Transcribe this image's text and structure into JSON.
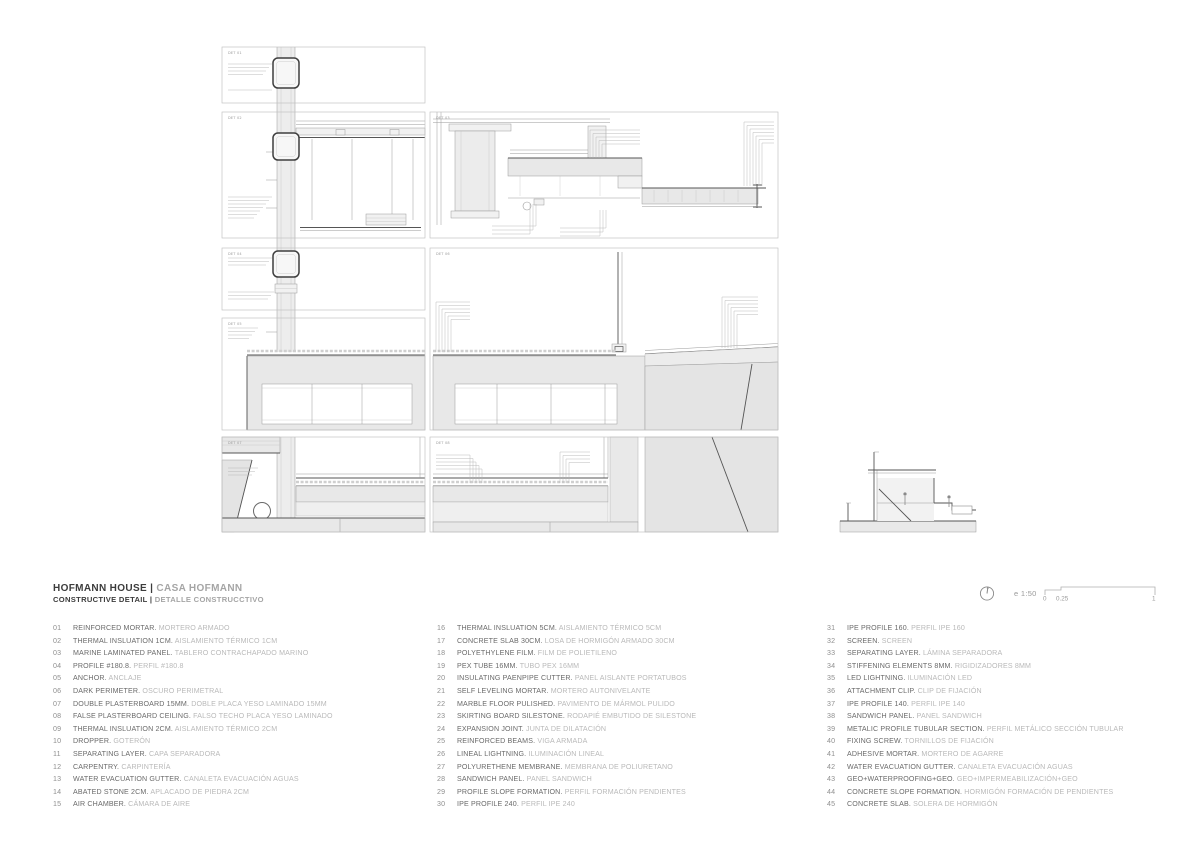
{
  "sheet": {
    "title_left": "HOFMANN HOUSE |",
    "title_right": "CASA HOFMANN",
    "subtitle_left": "CONSTRUCTIVE DETAIL |",
    "subtitle_right": "DETALLE CONSTRUCCTIVO"
  },
  "scale": {
    "label": "e 1:50",
    "tick0": "0",
    "tick025": "0.25",
    "tick1": "1"
  },
  "panels": [
    {
      "label": "DET 01"
    },
    {
      "label": "DET 02"
    },
    {
      "label": "DET 03"
    },
    {
      "label": "DET 04"
    },
    {
      "label": "DET 05"
    },
    {
      "label": "DET 06"
    },
    {
      "label": "DET 07"
    },
    {
      "label": "DET 08"
    }
  ],
  "colors": {
    "line_dark": "#555555",
    "line_light": "#9a9a9a",
    "fill_light": "#e8e8e8",
    "text_dark": "#3c3c3c",
    "text_mid": "#6a6a6a",
    "text_light": "#b9b9b9"
  },
  "legend": {
    "columns": [
      [
        {
          "num": "01",
          "en": "REINFORCED MORTAR.",
          "es": "MORTERO ARMADO"
        },
        {
          "num": "02",
          "en": "THERMAL INSLUATION 1CM.",
          "es": "AISLAMIENTO TÉRMICO 1CM"
        },
        {
          "num": "03",
          "en": "MARINE LAMINATED PANEL.",
          "es": "TABLERO CONTRACHAPADO MARINO"
        },
        {
          "num": "04",
          "en": "PROFILE #180.8.",
          "es": "PERFIL #180.8"
        },
        {
          "num": "05",
          "en": "ANCHOR.",
          "es": "ANCLAJE"
        },
        {
          "num": "06",
          "en": "DARK PERIMETER.",
          "es": "OSCURO PERIMETRAL"
        },
        {
          "num": "07",
          "en": "DOUBLE PLASTERBOARD 15MM.",
          "es": "DOBLE PLACA YESO LAMINADO 15MM"
        },
        {
          "num": "08",
          "en": "FALSE PLASTERBOARD CEILING.",
          "es": "FALSO TECHO PLACA YESO LAMINADO"
        },
        {
          "num": "09",
          "en": "THERMAL INSLUATION 2CM.",
          "es": "AISLAMIENTO TÉRMICO 2CM"
        },
        {
          "num": "10",
          "en": "DROPPER.",
          "es": "GOTERÓN"
        },
        {
          "num": "11",
          "en": "SEPARATING LAYER.",
          "es": "CAPA SEPARADORA"
        },
        {
          "num": "12",
          "en": "CARPENTRY.",
          "es": "CARPINTERÍA"
        },
        {
          "num": "13",
          "en": "WATER EVACUATION GUTTER.",
          "es": "CANALETA EVACUACIÓN AGUAS"
        },
        {
          "num": "14",
          "en": "ABATED STONE 2CM.",
          "es": "APLACADO DE PIEDRA 2CM"
        },
        {
          "num": "15",
          "en": "AIR CHAMBER.",
          "es": "CÁMARA DE AIRE"
        }
      ],
      [
        {
          "num": "16",
          "en": "THERMAL INSLUATION 5CM.",
          "es": "AISLAMIENTO TÉRMICO 5CM"
        },
        {
          "num": "17",
          "en": "CONCRETE SLAB 30CM.",
          "es": "LOSA DE HORMIGÓN ARMADO 30CM"
        },
        {
          "num": "18",
          "en": "POLYETHYLENE FILM.",
          "es": "FILM DE POLIETILENO"
        },
        {
          "num": "19",
          "en": "PEX TUBE 16MM.",
          "es": "TUBO PEX 16MM"
        },
        {
          "num": "20",
          "en": "INSULATING PAENPIPE CUTTER.",
          "es": "PANEL AISLANTE PORTATUBOS"
        },
        {
          "num": "21",
          "en": "SELF LEVELING MORTAR.",
          "es": "MORTERO AUTONIVELANTE"
        },
        {
          "num": "22",
          "en": "MARBLE FLOOR PULISHED.",
          "es": "PAVIMENTO DE MÁRMOL PULIDO"
        },
        {
          "num": "23",
          "en": "SKIRTING BOARD SILESTONE.",
          "es": "RODAPIÉ EMBUTIDO DE SILESTONE"
        },
        {
          "num": "24",
          "en": "EXPANSION JOINT.",
          "es": "JUNTA DE DILATACIÓN"
        },
        {
          "num": "25",
          "en": "REINFORCED BEAMS.",
          "es": "VIGA ARMADA"
        },
        {
          "num": "26",
          "en": "LINEAL LIGHTNING.",
          "es": "ILUMINACIÓN LINEAL"
        },
        {
          "num": "27",
          "en": "POLYURETHENE MEMBRANE.",
          "es": "MEMBRANA DE POLIURETANO"
        },
        {
          "num": "28",
          "en": "SANDWICH PANEL.",
          "es": "PANEL SANDWICH"
        },
        {
          "num": "29",
          "en": "PROFILE SLOPE FORMATION.",
          "es": "PERFIL FORMACIÓN PENDIENTES"
        },
        {
          "num": "30",
          "en": "IPE PROFILE 240.",
          "es": "PERFIL IPE 240"
        }
      ],
      [
        {
          "num": "31",
          "en": "IPE PROFILE 160.",
          "es": "PERFIL IPE 160"
        },
        {
          "num": "32",
          "en": "SCREEN.",
          "es": "SCREEN"
        },
        {
          "num": "33",
          "en": "SEPARATING LAYER.",
          "es": "LÁMINA SEPARADORA"
        },
        {
          "num": "34",
          "en": "STIFFENING ELEMENTS 8MM.",
          "es": "RIGIDIZADORES 8MM"
        },
        {
          "num": "35",
          "en": "LED LIGHTNING.",
          "es": "ILUMINACIÓN LED"
        },
        {
          "num": "36",
          "en": "ATTACHMENT CLIP.",
          "es": "CLIP DE FIJACIÓN"
        },
        {
          "num": "37",
          "en": "IPE PROFILE 140.",
          "es": "PERFIL IPE 140"
        },
        {
          "num": "38",
          "en": "SANDWICH PANEL.",
          "es": "PANEL SANDWICH"
        },
        {
          "num": "39",
          "en": "METALIC PROFILE TUBULAR SECTION.",
          "es": "PERFIL METÁLICO SECCIÓN TUBULAR"
        },
        {
          "num": "40",
          "en": "FIXING SCREW.",
          "es": "TORNILLOS DE FIJACIÓN"
        },
        {
          "num": "41",
          "en": "ADHESIVE MORTAR.",
          "es": "MORTERO DE AGARRE"
        },
        {
          "num": "42",
          "en": "WATER EVACUATION GUTTER.",
          "es": "CANALETA EVACUACIÓN AGUAS"
        },
        {
          "num": "43",
          "en": "GEO+WATERPROOFING+GEO.",
          "es": "GEO+IMPERMEABILIZACIÓN+GEO"
        },
        {
          "num": "44",
          "en": "CONCRETE SLOPE FORMATION.",
          "es": "HORMIGÓN FORMACIÓN DE PENDIENTES"
        },
        {
          "num": "45",
          "en": "CONCRETE SLAB.",
          "es": "SOLERA DE HORMIGÓN"
        }
      ]
    ]
  }
}
